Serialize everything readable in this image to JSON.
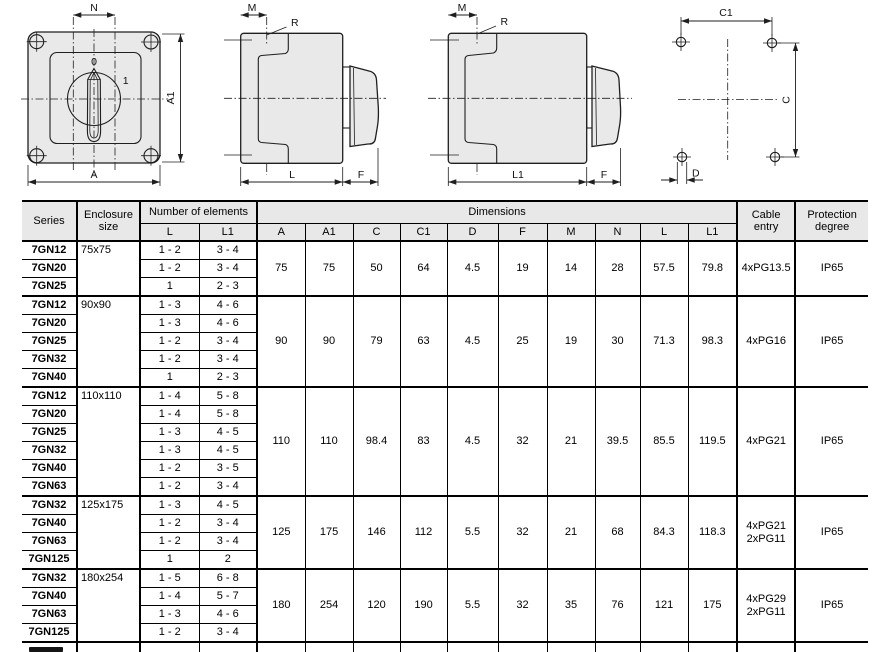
{
  "drawings": {
    "front_view": {
      "dim_top": "N",
      "dim_bottom": "A",
      "dim_right": "A1",
      "position_0": "0",
      "position_1": "1"
    },
    "side_view_short": {
      "dim_top": "M",
      "radius": "R",
      "dim_bottom": "L",
      "dim_front": "F"
    },
    "side_view_long": {
      "dim_top": "M",
      "radius": "R",
      "dim_bottom": "L1",
      "dim_front": "F"
    },
    "drilling_plan": {
      "dim_top": "C1",
      "dim_right": "C",
      "dim_hole": "D"
    }
  },
  "colors": {
    "line": "#1f1f1f",
    "drawing_fill": "#e9e9e9",
    "header_bg": "#e8e8e8",
    "table_line": "#000000"
  },
  "table": {
    "headers": {
      "series": "Series",
      "enclosure_size": "Enclosure size",
      "number_of_elements": "Number of elements",
      "el_l": "L",
      "el_l1": "L1",
      "dimensions": "Dimensions",
      "a": "A",
      "a1": "A1",
      "c": "C",
      "c1": "C1",
      "d": "D",
      "f": "F",
      "m": "M",
      "n": "N",
      "dim_l": "L",
      "dim_l1": "L1",
      "cable_entry": "Cable entry",
      "protection_degree": "Protection degree"
    },
    "dim_order": [
      "A",
      "A1",
      "C",
      "C1",
      "D",
      "F",
      "M",
      "N",
      "L",
      "L1"
    ],
    "groups": [
      {
        "enclosure_size": "75x75",
        "rows": [
          {
            "series": "7GN12",
            "l": "1 - 2",
            "l1": "3 - 4"
          },
          {
            "series": "7GN20",
            "l": "1 - 2",
            "l1": "3 - 4"
          },
          {
            "series": "7GN25",
            "l": "1",
            "l1": "2 - 3"
          }
        ],
        "dims": {
          "A": "75",
          "A1": "75",
          "C": "50",
          "C1": "64",
          "D": "4.5",
          "F": "19",
          "M": "14",
          "N": "28",
          "L": "57.5",
          "L1": "79.8"
        },
        "cable_entry": [
          "4xPG13.5"
        ],
        "protection_degree": "IP65"
      },
      {
        "enclosure_size": "90x90",
        "rows": [
          {
            "series": "7GN12",
            "l": "1 - 3",
            "l1": "4 - 6"
          },
          {
            "series": "7GN20",
            "l": "1 - 3",
            "l1": "4 - 6"
          },
          {
            "series": "7GN25",
            "l": "1 - 2",
            "l1": "3 - 4"
          },
          {
            "series": "7GN32",
            "l": "1 - 2",
            "l1": "3 - 4"
          },
          {
            "series": "7GN40",
            "l": "1",
            "l1": "2 - 3"
          }
        ],
        "dims": {
          "A": "90",
          "A1": "90",
          "C": "79",
          "C1": "63",
          "D": "4.5",
          "F": "25",
          "M": "19",
          "N": "30",
          "L": "71.3",
          "L1": "98.3"
        },
        "cable_entry": [
          "4xPG16"
        ],
        "protection_degree": "IP65"
      },
      {
        "enclosure_size": "110x110",
        "rows": [
          {
            "series": "7GN12",
            "l": "1 - 4",
            "l1": "5 - 8"
          },
          {
            "series": "7GN20",
            "l": "1 - 4",
            "l1": "5 - 8"
          },
          {
            "series": "7GN25",
            "l": "1 - 3",
            "l1": "4 - 5"
          },
          {
            "series": "7GN32",
            "l": "1 - 3",
            "l1": "4 - 5"
          },
          {
            "series": "7GN40",
            "l": "1 - 2",
            "l1": "3 - 5"
          },
          {
            "series": "7GN63",
            "l": "1 - 2",
            "l1": "3 - 4"
          }
        ],
        "dims": {
          "A": "110",
          "A1": "110",
          "C": "98.4",
          "C1": "83",
          "D": "4.5",
          "F": "32",
          "M": "21",
          "N": "39.5",
          "L": "85.5",
          "L1": "119.5"
        },
        "cable_entry": [
          "4xPG21"
        ],
        "protection_degree": "IP65"
      },
      {
        "enclosure_size": "125x175",
        "rows": [
          {
            "series": "7GN32",
            "l": "1 - 3",
            "l1": "4 - 5"
          },
          {
            "series": "7GN40",
            "l": "1 - 2",
            "l1": "3 - 4"
          },
          {
            "series": "7GN63",
            "l": "1 - 2",
            "l1": "3 - 4"
          },
          {
            "series": "7GN125",
            "l": "1",
            "l1": "2"
          }
        ],
        "dims": {
          "A": "125",
          "A1": "175",
          "C": "146",
          "C1": "112",
          "D": "5.5",
          "F": "32",
          "M": "21",
          "N": "68",
          "L": "84.3",
          "L1": "118.3"
        },
        "cable_entry": [
          "4xPG21",
          "2xPG11"
        ],
        "protection_degree": "IP65"
      },
      {
        "enclosure_size": "180x254",
        "rows": [
          {
            "series": "7GN32",
            "l": "1 - 5",
            "l1": "6 - 8"
          },
          {
            "series": "7GN40",
            "l": "1 - 4",
            "l1": "5 - 7"
          },
          {
            "series": "7GN63",
            "l": "1 - 3",
            "l1": "4 - 6"
          },
          {
            "series": "7GN125",
            "l": "1 - 2",
            "l1": "3 - 4"
          }
        ],
        "dims": {
          "A": "180",
          "A1": "254",
          "C": "120",
          "C1": "190",
          "D": "5.5",
          "F": "32",
          "M": "35",
          "N": "76",
          "L": "121",
          "L1": "175"
        },
        "cable_entry": [
          "4xPG29",
          "2xPG11"
        ],
        "protection_degree": "IP65"
      }
    ]
  }
}
